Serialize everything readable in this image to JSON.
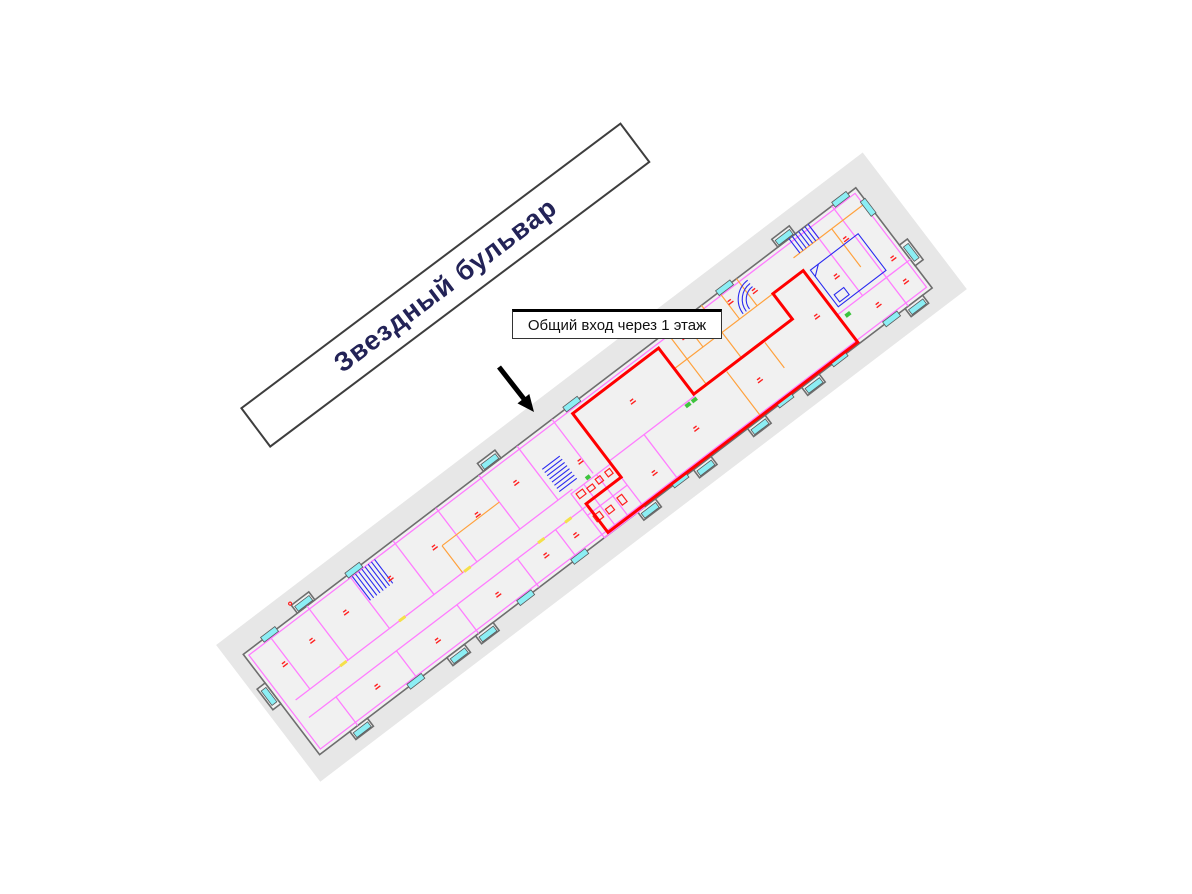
{
  "street": {
    "name": "Звездный бульвар"
  },
  "callout": {
    "text": "Общий вход через 1 этаж"
  },
  "icons": {
    "entrance_arrow_icon": "black-diagonal-arrow-down-right"
  },
  "palette": {
    "site_gray": "#e7e7e7",
    "room_fill": "#f1f1f1",
    "outline_gray": "#6e6e6e",
    "wall_magenta": "#ff7dff",
    "partition_orange": "#ffa23e",
    "window_cyan": "#8ceef4",
    "stair_blue": "#2a2af0",
    "door_yellow": "#f5e04a",
    "fixture_red": "#ff2020",
    "highlight_red": "#ff0000",
    "accent_green": "#3ec43e",
    "street_text": "#232357",
    "arrow_black": "#000000"
  }
}
